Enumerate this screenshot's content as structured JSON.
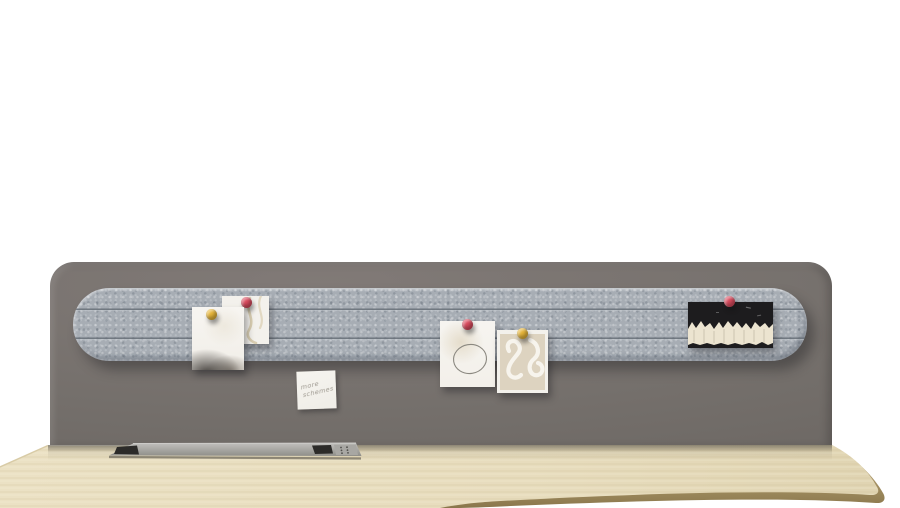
{
  "scene": {
    "label": "desk-with-privacy-panel-and-felt-pin-rail"
  },
  "colors": {
    "background": "#ffffff",
    "panel": "#746f6b",
    "felt": "#a7adb4",
    "felt-groove": "#5f6770",
    "desk-top": "#e7dcbd",
    "desk-edge": "#c7b183",
    "desk-edge-dark": "#8a774c",
    "tray": "#b3b2ae",
    "tray-slot": "#2c2b29",
    "pin-red": "#d94b5e",
    "pin-yellow": "#e6b53a",
    "card-white": "#f3f1ec",
    "card-beige": "#ddd3c0",
    "photo-dark": "#1d1c1e",
    "torn-white": "#ece4d0",
    "note-paper": "#efede7",
    "note-ink": "#8f8a80"
  },
  "note": {
    "lines": [
      "more",
      "schemes"
    ]
  },
  "pinboard": {
    "items": [
      {
        "name": "map-sketch-card",
        "pin": "#d94b5e"
      },
      {
        "name": "smoke-photo",
        "pin": "#e6b53a"
      },
      {
        "name": "circle-sketch-card",
        "pin": "#d94b5e"
      },
      {
        "name": "squiggle-art-card",
        "pin": "#e6b53a"
      },
      {
        "name": "dark-torn-photo",
        "pin": "#d94b5e"
      }
    ]
  }
}
